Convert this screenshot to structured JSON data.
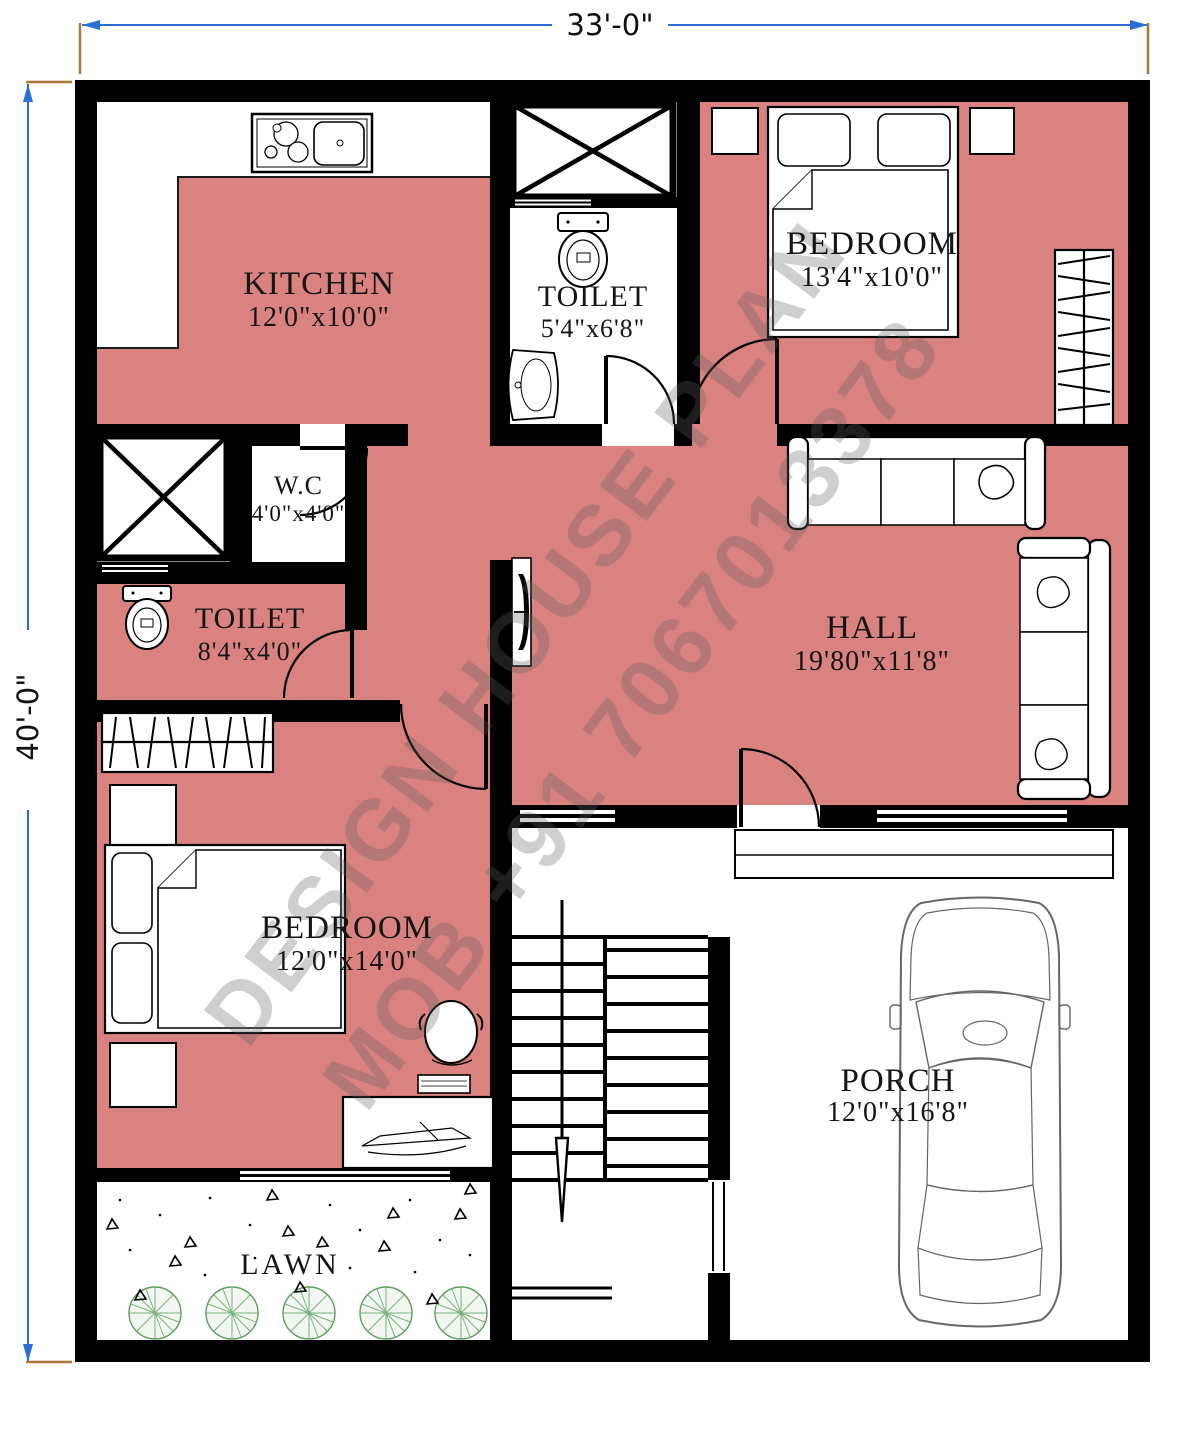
{
  "title": "33x40 house floor plan",
  "dimensions": {
    "width": "33'-0\"",
    "height": "40'-0\""
  },
  "watermark": {
    "line1": "DESIGN HOUSE PLAN",
    "line2": "MOB +91 7067013378"
  },
  "rooms": {
    "kitchen": {
      "name": "KITCHEN",
      "size": "12'0\"x10'0\""
    },
    "toilet_top": {
      "name": "TOILET",
      "size": "5'4\"x6'8\""
    },
    "bedroom_top": {
      "name": "BEDROOM",
      "size": "13'4\"x10'0\""
    },
    "wc": {
      "name": "W.C",
      "size": "4'0\"x4'0\""
    },
    "toilet_left": {
      "name": "TOILET",
      "size": "8'4\"x4'0\""
    },
    "hall": {
      "name": "HALL",
      "size": "19'80\"x11'8\""
    },
    "bedroom_bottom": {
      "name": "BEDROOM",
      "size": "12'0\"x14'0\""
    },
    "porch": {
      "name": "PORCH",
      "size": "12'0\"x16'8\""
    },
    "lawn": {
      "name": "LAWN"
    }
  },
  "colors": {
    "room_fill": "#d9827f",
    "wall": "#000000",
    "dimension_line": "#2b6fd6",
    "extension_line": "#a9763c",
    "tree": "#5a9e5a"
  }
}
